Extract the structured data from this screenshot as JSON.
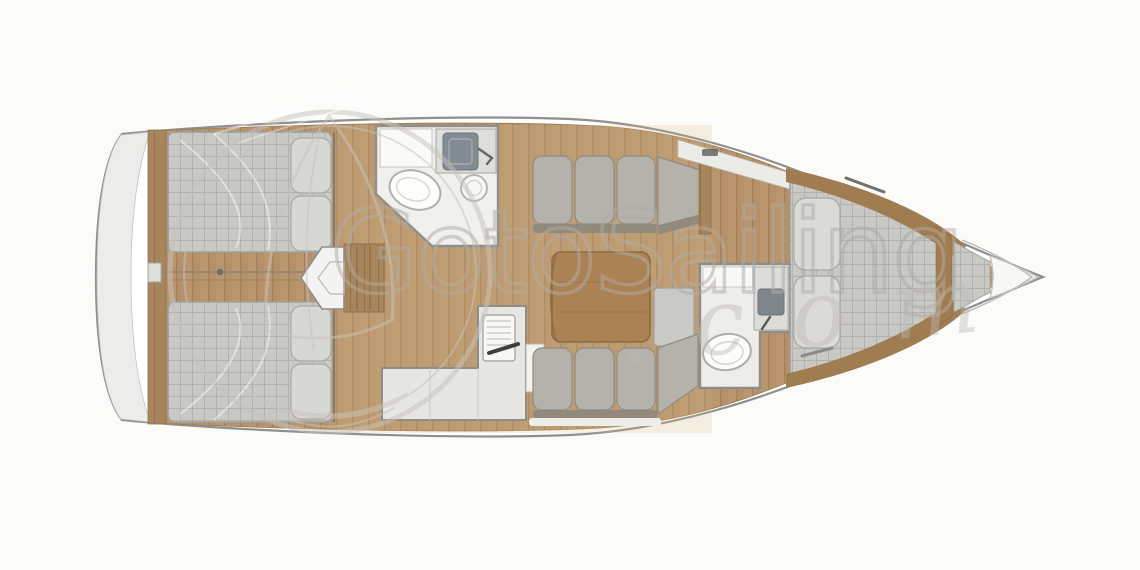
{
  "watermark": {
    "brand": "GotoSailing",
    "domain_suffix": ".com",
    "logo": "circular-sail-emblem",
    "color": "#b2aca4"
  },
  "diagram": {
    "type": "boat-floor-plan",
    "subject": "sailing-yacht-interior-top-view",
    "orientation": "bow-right-stern-left",
    "colors": {
      "background": "#fbfbfa",
      "hull_outline": "#8f8f8d",
      "deck_white": "#f2f2f0",
      "wood_floor": "#b5916a",
      "wood_trim": "#a8855c",
      "mattress_gray": "#c8c8c5",
      "sofa_gray": "#b4b2aa",
      "fixture_white": "#f0f0ee",
      "wall_gray": "#8f8d89"
    },
    "areas": [
      {
        "name": "stern-transom"
      },
      {
        "name": "aft-cabin-top",
        "features": [
          "double-berth",
          "two-pillows"
        ]
      },
      {
        "name": "aft-cabin-bottom",
        "features": [
          "double-berth",
          "two-pillows"
        ]
      },
      {
        "name": "companionway-steps"
      },
      {
        "name": "aft-head",
        "features": [
          "toilet",
          "sink-basin",
          "round-washbasin",
          "counter"
        ]
      },
      {
        "name": "galley",
        "features": [
          "l-shaped-counter",
          "stove-with-handle",
          "fridge"
        ]
      },
      {
        "name": "saloon",
        "features": [
          "sofa-top",
          "sofa-bottom",
          "wood-table",
          "stool"
        ]
      },
      {
        "name": "forward-head",
        "features": [
          "toilet",
          "sink-basin",
          "cabinet"
        ]
      },
      {
        "name": "forward-cabin",
        "features": [
          "v-berth",
          "two-pillows",
          "wood-trim"
        ]
      },
      {
        "name": "bow-anchor-locker"
      }
    ]
  }
}
